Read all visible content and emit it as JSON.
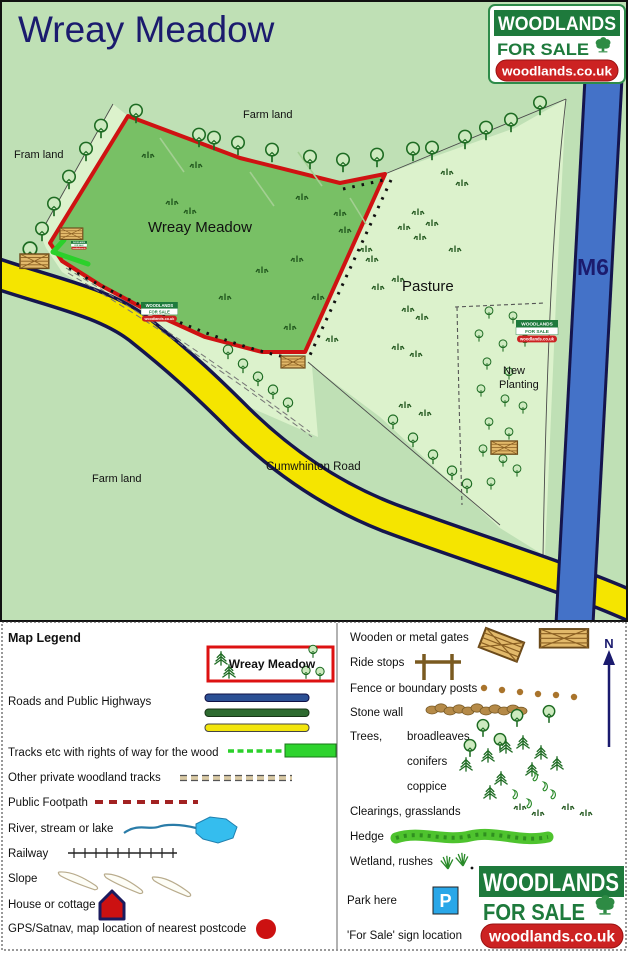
{
  "title": "Wreay Meadow",
  "brand": {
    "line1": "WOODLANDS",
    "line2": "FOR SALE",
    "line3": "woodlands.co.uk"
  },
  "map": {
    "labels": {
      "farm_top": "Farm land",
      "fram_left": "Fram land",
      "farm_bottom": "Farm land",
      "wood": "Wreay Meadow",
      "pasture": "Pasture",
      "new1": "New",
      "new2": "Planting",
      "road": "Cumwhinton Road",
      "motorway": "M6"
    }
  },
  "legend": {
    "heading": "Map Legend",
    "wood_box": "Wreay Meadow",
    "north": "N",
    "park_symbol": "P",
    "left": [
      {
        "label": "Roads and Public Highways"
      },
      {
        "label": "Tracks etc with rights of way for the wood"
      },
      {
        "label": "Other private woodland tracks"
      },
      {
        "label": "Public Footpath"
      },
      {
        "label": "River, stream or lake"
      },
      {
        "label": "Railway"
      },
      {
        "label": "Slope"
      },
      {
        "label": "House or cottage"
      },
      {
        "label": "GPS/Satnav, map location of nearest postcode"
      }
    ],
    "right": [
      {
        "label": "Wooden or metal gates"
      },
      {
        "label": "Ride stops"
      },
      {
        "label": "Fence or boundary posts"
      },
      {
        "label": "Stone wall"
      },
      {
        "label": "Trees,"
      },
      {
        "label": "broadleaves"
      },
      {
        "label": "conifers"
      },
      {
        "label": "coppice"
      },
      {
        "label": "Clearings, grasslands"
      },
      {
        "label": "Hedge"
      },
      {
        "label": "Wetland, rushes"
      },
      {
        "label": "Park here"
      },
      {
        "label": "'For Sale' sign location"
      }
    ]
  },
  "colors": {
    "background": "#bfe0b5",
    "meadow": "#78c065",
    "pasture": "#dcf2cc",
    "boundary_red": "#cf1212",
    "road_yellow": "#f5e500",
    "motorway_blue": "#4472c8",
    "navy": "#1b1b6e",
    "brand_green": "#1e7a3c",
    "brand_red": "#cc2222"
  }
}
